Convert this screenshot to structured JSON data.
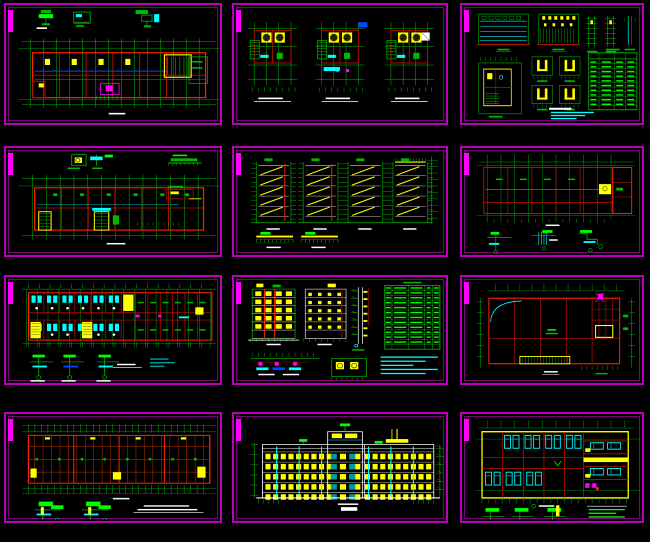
{
  "app": {
    "description": "grid of twelve CAD architectural drawing sheet thumbnails on black background",
    "grid": {
      "columns": 3,
      "rows": 4
    }
  },
  "colors": {
    "background": "#000000",
    "frame": "#bb00bb",
    "frame_inner": "#7d007d",
    "tab": "#ff00ff",
    "green": "#00b800",
    "bright_green": "#00ff00",
    "red": "#bb1100",
    "bright_red": "#ff2200",
    "dark_red": "#9a2a00",
    "yellow": "#ffff00",
    "cyan": "#00ffff",
    "teal": "#009a9a",
    "blue": "#0048ff",
    "white": "#ffffff",
    "magenta": "#ff00ff"
  },
  "panels": [
    {
      "id": 1,
      "kind": "long-plan",
      "name": "floor-plan-sheet-1"
    },
    {
      "id": 2,
      "kind": "unit-plans",
      "name": "unit-detail-plans-sheet"
    },
    {
      "id": 3,
      "kind": "elevation-sheet",
      "name": "elevations-details-schedule-sheet"
    },
    {
      "id": 4,
      "kind": "long-plan-2",
      "name": "floor-plan-sheet-2"
    },
    {
      "id": 5,
      "kind": "stair-sections",
      "name": "stair-sections-sheet"
    },
    {
      "id": 6,
      "kind": "plan-details",
      "name": "floor-plan-with-details-sheet"
    },
    {
      "id": 7,
      "kind": "dorm-plan",
      "name": "dormitory-floor-plan-sheet"
    },
    {
      "id": 8,
      "kind": "elevation-sheet-2",
      "name": "side-elevations-and-schedule-sheet"
    },
    {
      "id": 9,
      "kind": "roof-plan",
      "name": "roof-plan-sheet"
    },
    {
      "id": 10,
      "kind": "struct-plan",
      "name": "structural-floor-plan-sheet"
    },
    {
      "id": 11,
      "kind": "front-elevation",
      "name": "front-elevation-sheet"
    },
    {
      "id": 12,
      "kind": "parking-plan",
      "name": "garage-floor-plan-sheet"
    }
  ]
}
